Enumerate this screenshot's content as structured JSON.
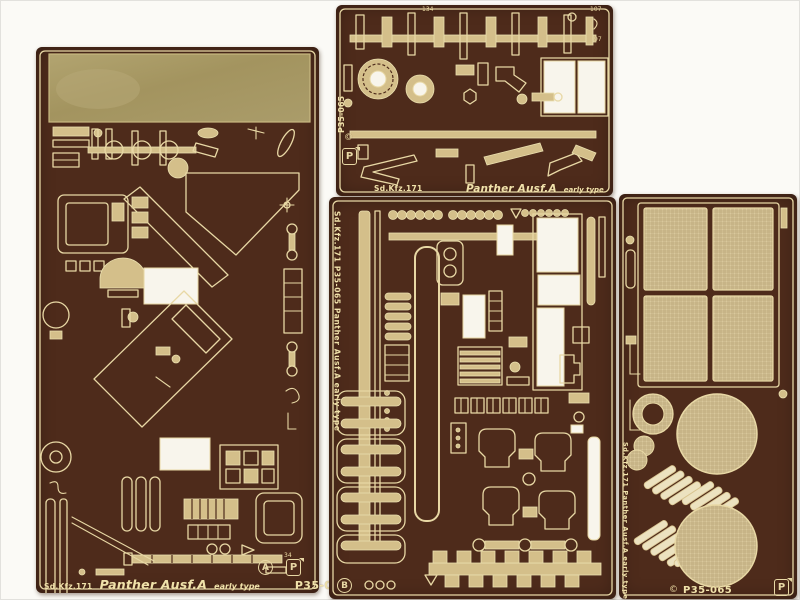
{
  "colors": {
    "background": "#fbfaf6",
    "fret_brown": "#4e2b1b",
    "etch_cream": "#e8d8a5",
    "part_tan": "#d4bf8a",
    "brass_plate": "#a99a67",
    "cutout_white": "#f8f5ec",
    "mesh_tan": "#d9c89c"
  },
  "marks": {
    "copyright": "©",
    "brand_letter": "P"
  },
  "sheet_left": {
    "sheet_letter": "A",
    "footer_code": "Sd.Kfz.171",
    "footer_name": "Panther Ausf.A",
    "footer_variant": "early type",
    "footer_part_number": "P35-065",
    "tiny_number_34": "34"
  },
  "sheet_top_middle": {
    "edge_part_number": "P35-065",
    "footer_code": "Sd.Kfz.171",
    "footer_name": "Panther Ausf.A",
    "footer_variant": "early type",
    "tiny_number_134": "134",
    "tiny_number_107": "107",
    "tiny_number_97": "97"
  },
  "sheet_bottom_middle": {
    "sheet_letter": "B",
    "edge_text": "Sd.Kfz.171  P35-065  Panther Ausf.A early type"
  },
  "sheet_right": {
    "edge_text": "Sd.Kfz.171  Panther Ausf.A early type",
    "footer_part_number": "P35-065"
  }
}
